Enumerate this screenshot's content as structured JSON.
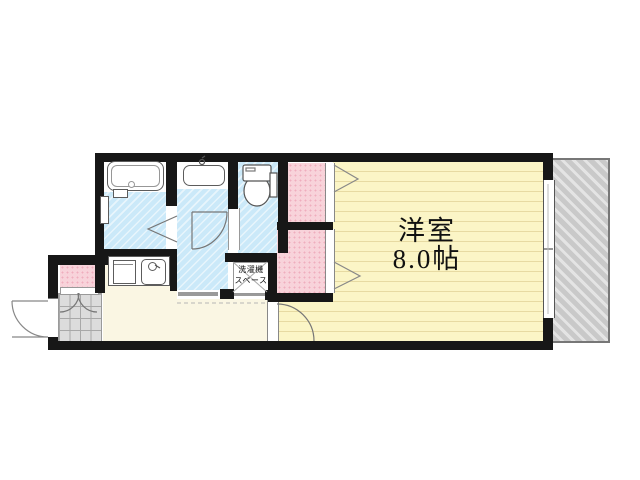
{
  "plan": {
    "main_room": {
      "name": "洋室",
      "size": "8.0帖"
    },
    "laundry_space": {
      "line1": "洗濯機",
      "line2": "スペース"
    }
  },
  "colors": {
    "wall": "#171717",
    "wet_area_fill": "#cbe9f9",
    "closet_fill": "#f8d3da",
    "main_room_fill": "#fbf5c6",
    "hall_fill": "#faf6e3",
    "entrance_tile_fill": "#dcdcdc",
    "balcony_fill": "#c9c9c9",
    "fixture_outline": "#5c5c5c"
  }
}
